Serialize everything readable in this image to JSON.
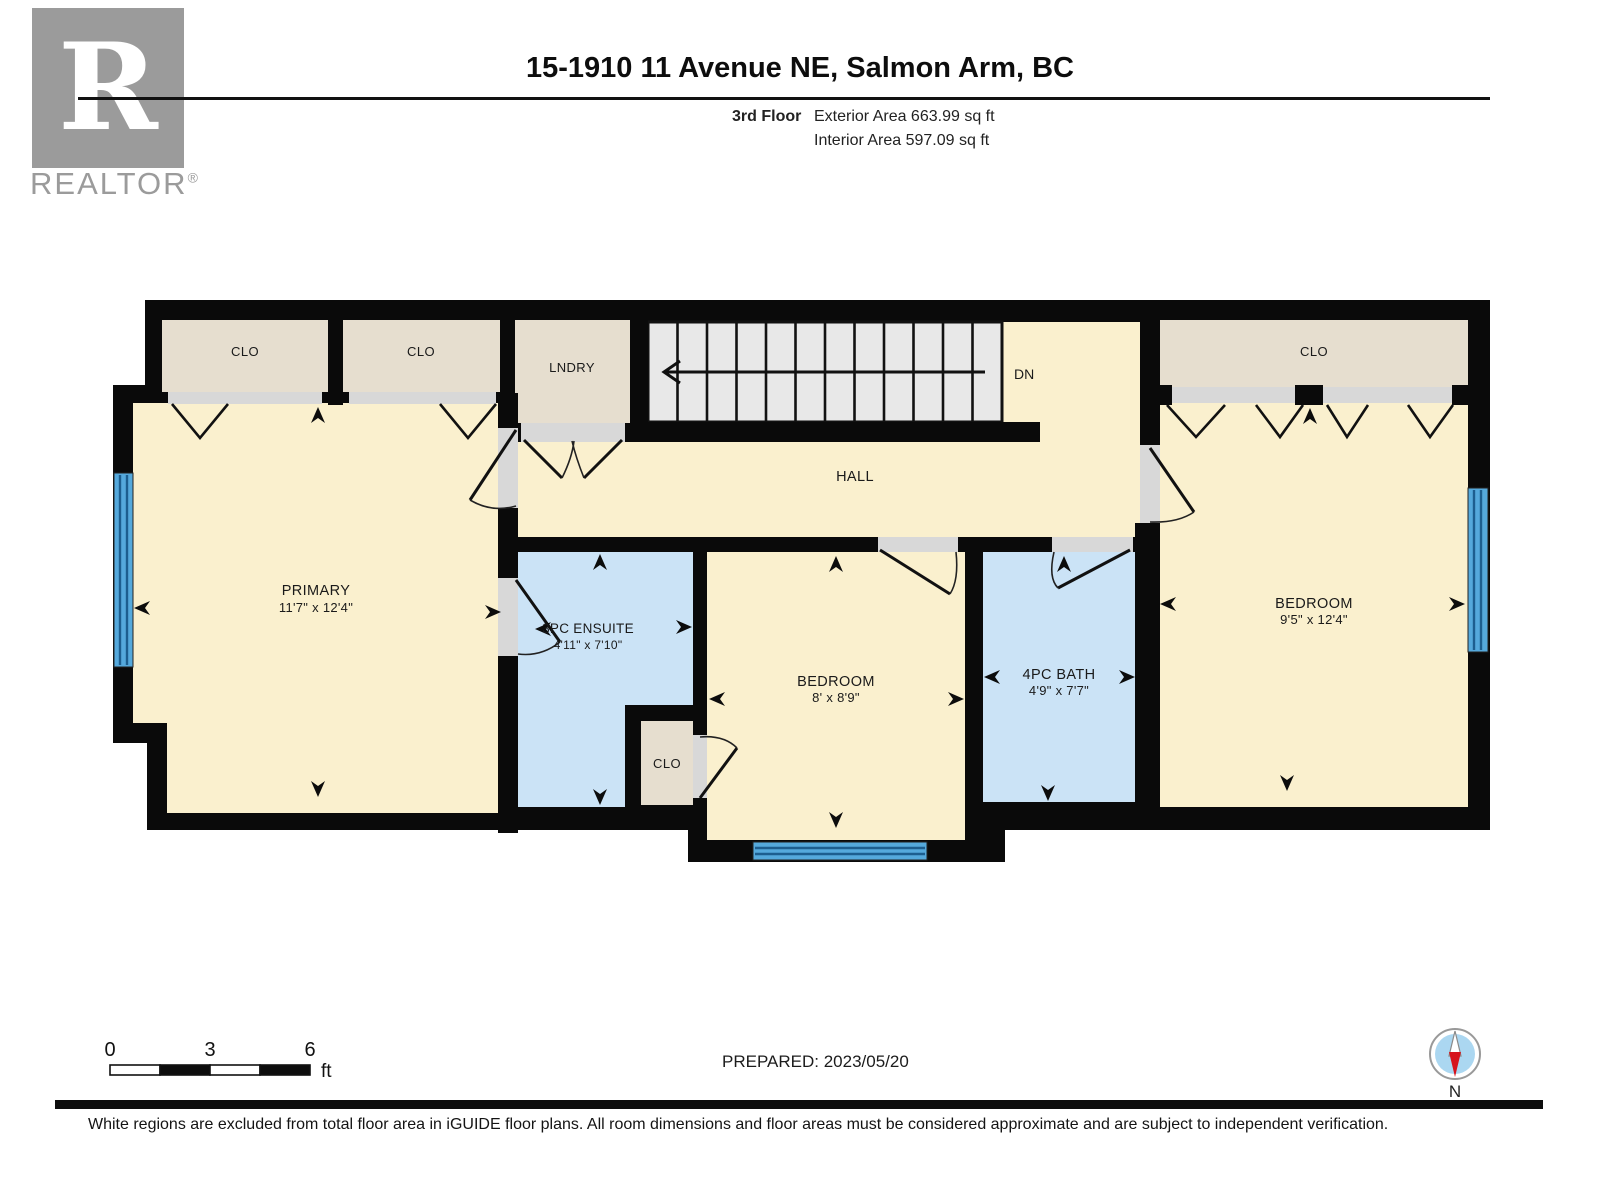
{
  "header": {
    "title": "15-1910 11 Avenue NE, Salmon Arm, BC",
    "floor_label": "3rd Floor",
    "exterior_area": "Exterior Area 663.99 sq ft",
    "interior_area": "Interior Area 597.09 sq ft"
  },
  "logo": {
    "letter": "R",
    "word": "REALTOR",
    "registered": "®"
  },
  "plan": {
    "rooms": {
      "closet1": {
        "label": "CLO"
      },
      "closet2": {
        "label": "CLO"
      },
      "laundry": {
        "label": "LNDRY"
      },
      "stairs": {
        "label": "DN"
      },
      "hall": {
        "label": "HALL"
      },
      "primary": {
        "label": "PRIMARY",
        "dims": "11'7\" x 12'4\""
      },
      "ensuite": {
        "label": "3PC ENSUITE",
        "dims": "4'11\" x 7'10\""
      },
      "closet3": {
        "label": "CLO"
      },
      "bedroom_mid": {
        "label": "BEDROOM",
        "dims": "8' x 8'9\""
      },
      "bath": {
        "label": "4PC BATH",
        "dims": "4'9\" x 7'7\""
      },
      "closet4": {
        "label": "CLO"
      },
      "bedroom_right": {
        "label": "BEDROOM",
        "dims": "9'5\" x 12'4\""
      }
    },
    "markers": [
      {
        "x": 318,
        "y": 415,
        "dir": "up"
      },
      {
        "x": 600,
        "y": 562,
        "dir": "up"
      },
      {
        "x": 836,
        "y": 564,
        "dir": "up"
      },
      {
        "x": 1064,
        "y": 564,
        "dir": "up"
      },
      {
        "x": 1310,
        "y": 416,
        "dir": "up"
      },
      {
        "x": 318,
        "y": 789,
        "dir": "down"
      },
      {
        "x": 600,
        "y": 797,
        "dir": "down"
      },
      {
        "x": 836,
        "y": 820,
        "dir": "down"
      },
      {
        "x": 1048,
        "y": 793,
        "dir": "down"
      },
      {
        "x": 1287,
        "y": 783,
        "dir": "down"
      },
      {
        "x": 142,
        "y": 608,
        "dir": "left"
      },
      {
        "x": 543,
        "y": 629,
        "dir": "left"
      },
      {
        "x": 717,
        "y": 699,
        "dir": "left"
      },
      {
        "x": 992,
        "y": 677,
        "dir": "left"
      },
      {
        "x": 1168,
        "y": 604,
        "dir": "left"
      },
      {
        "x": 493,
        "y": 612,
        "dir": "right"
      },
      {
        "x": 684,
        "y": 627,
        "dir": "right"
      },
      {
        "x": 956,
        "y": 699,
        "dir": "right"
      },
      {
        "x": 1127,
        "y": 677,
        "dir": "right"
      },
      {
        "x": 1457,
        "y": 604,
        "dir": "right"
      }
    ],
    "colors": {
      "room_cream": "#FAF0CE",
      "closet_tan": "#E6DECF",
      "wet_blue": "#CBE3F6",
      "stairs_gray": "#E8E8E8",
      "doorway_gray": "#D8D8D8",
      "window_blue": "#55A9DC",
      "window_line": "#1D5E8F",
      "wall_black": "#0A0A0A"
    }
  },
  "scale_bar": {
    "tick0": "0",
    "tick1": "3",
    "tick2": "6",
    "unit": "ft"
  },
  "footer": {
    "prepared": "PREPARED: 2023/05/20",
    "compass_n": "N",
    "disclaimer": "White regions are excluded from total floor area in iGUIDE floor plans. All room dimensions and floor areas must be considered approximate and are subject to independent verification."
  }
}
